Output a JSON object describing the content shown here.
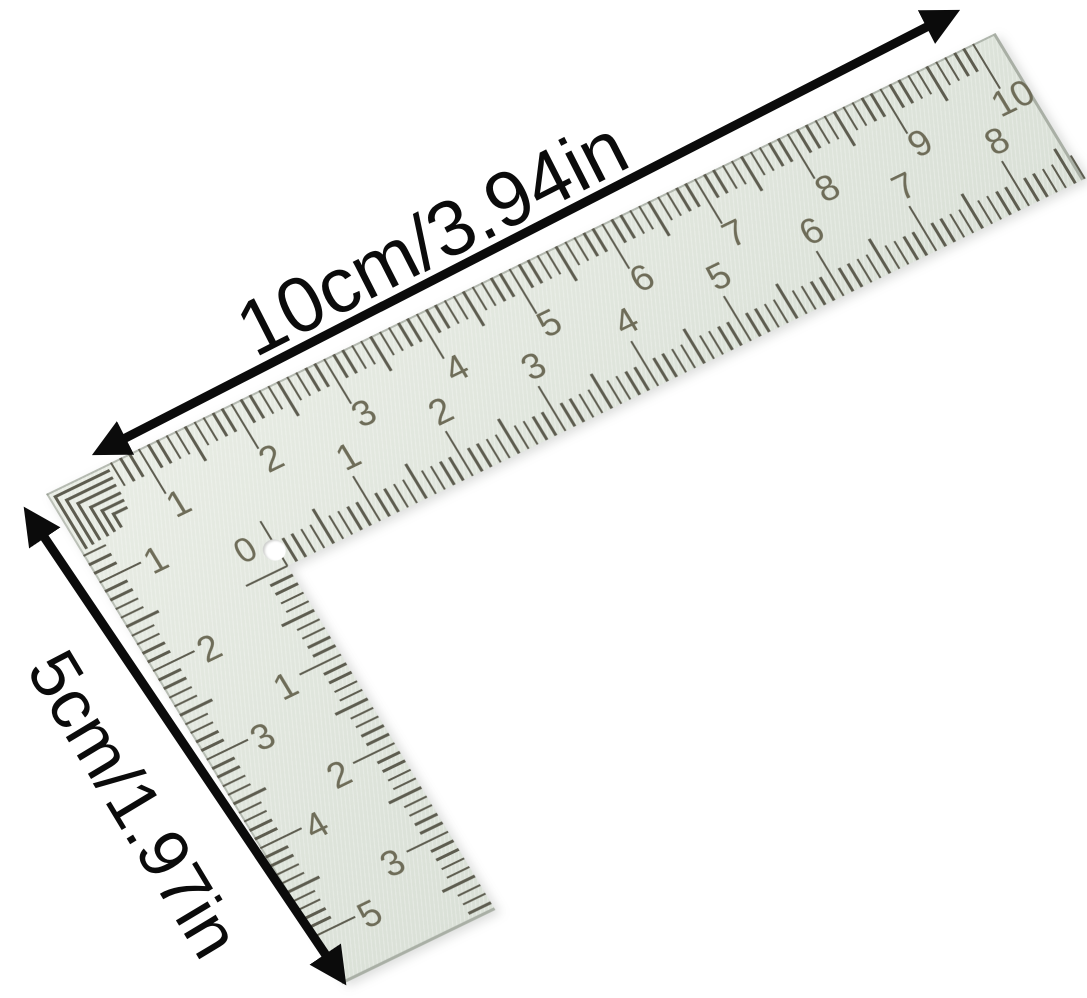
{
  "canvas": {
    "width": 1087,
    "height": 998,
    "background": "#ffffff"
  },
  "dimension_annotations": {
    "horizontal_label": "10cm/3.94in",
    "vertical_label": "5cm/1.97in",
    "arrow_color": "#0b0b0b"
  },
  "ruler": {
    "type": "L-square ruler",
    "corner_zero_label": "0",
    "colors": {
      "body": "#dde3da",
      "body_highlight": "#e9ede5",
      "body_shadow": "#d2d9cf",
      "tick": "#5d5c4f",
      "number": "#6e6c58",
      "edge": "#a9afa5"
    },
    "scales": {
      "outer_horizontal": {
        "unit": "cm",
        "length_cm": 10,
        "first_tick_mm": 7,
        "last_tick_mm": 100,
        "numbers": [
          1,
          2,
          3,
          4,
          5,
          6,
          7,
          8,
          9,
          10
        ]
      },
      "inner_horizontal": {
        "unit": "cm",
        "length_cm": 8,
        "first_tick_mm": 0,
        "last_tick_mm": 86,
        "numbers": [
          1,
          2,
          3,
          4,
          5,
          6,
          7,
          8
        ]
      },
      "outer_vertical": {
        "unit": "cm",
        "length_cm": 5,
        "first_tick_mm": 7,
        "last_tick_mm": 50,
        "numbers": [
          1,
          2,
          3,
          4,
          5
        ]
      },
      "inner_vertical": {
        "unit": "cm",
        "length_cm": 3,
        "first_tick_mm": 0,
        "last_tick_mm": 38,
        "numbers": [
          1,
          2,
          3
        ]
      }
    }
  }
}
